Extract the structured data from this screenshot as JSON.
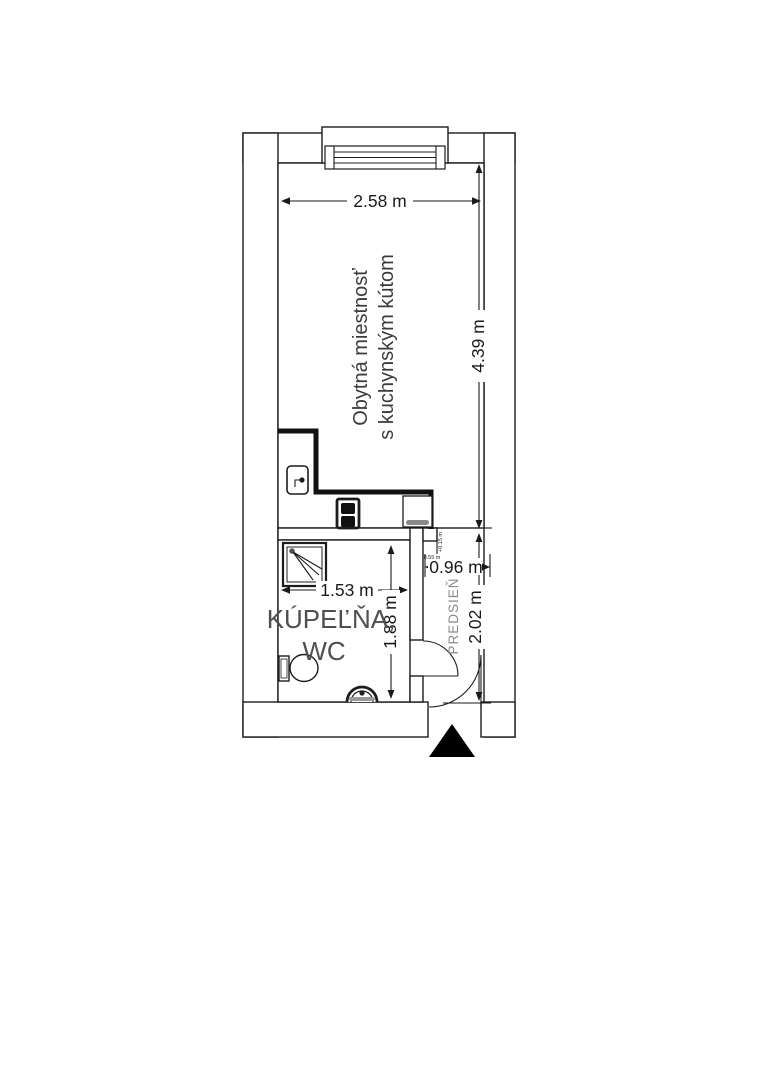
{
  "floorplan": {
    "rooms": {
      "living_room": {
        "name_line1": "Obytná miestnosť",
        "name_line2": "s kuchynským kútom"
      },
      "bathroom": {
        "name_line1": "KÚPEĽŇA,",
        "name_line2": "WC"
      },
      "hallway": {
        "name": "PREDSIEŇ"
      }
    },
    "dimensions": {
      "living_width": "2.58 m",
      "living_length": "4.39 m",
      "bathroom_width": "1.53 m",
      "bathroom_length": "1.88 m",
      "hallway_width": "0.96 m",
      "hallway_length": "2.02 m",
      "step_note": "+0.15 m",
      "door_note": "0.55 m"
    },
    "colors": {
      "wall_line": "#1c1c1c",
      "living_label": "#3b3b3b",
      "bathroom_label": "#4f4f4f",
      "hallway_label": "#8a8a8a",
      "dim_text": "#1a1a1a"
    },
    "fixtures": [
      "window",
      "kitchen-counter",
      "kitchen-sink",
      "stove",
      "refrigerator",
      "shower",
      "toilet",
      "washbasin",
      "bathroom-door",
      "entrance-door",
      "entrance-arrow"
    ]
  }
}
